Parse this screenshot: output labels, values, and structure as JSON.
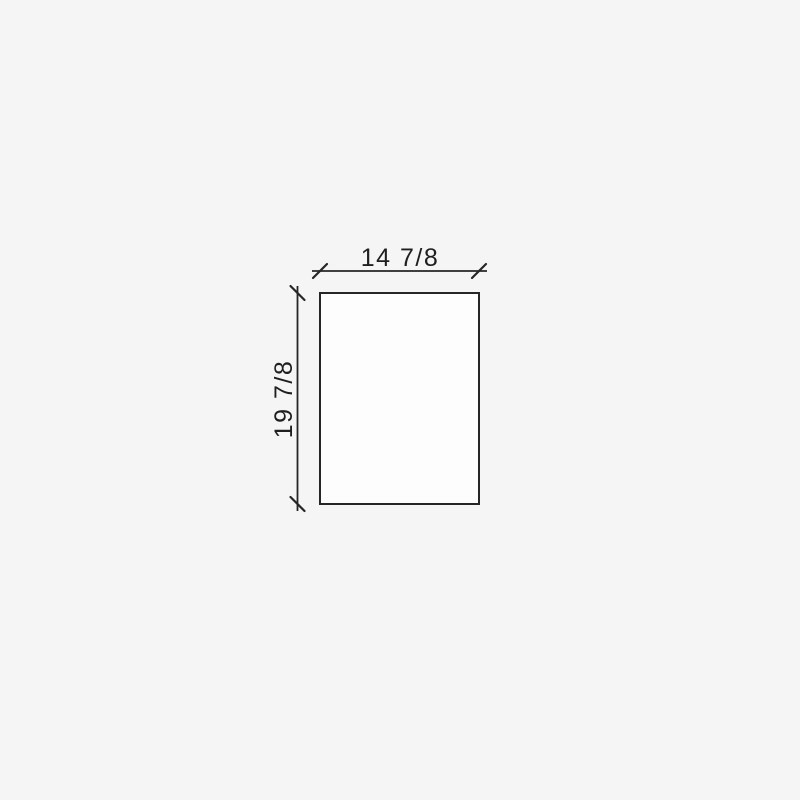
{
  "drawing": {
    "shape": "rectangle",
    "dimensions": {
      "width_label": "14 7/8",
      "height_label": "19 7/8"
    },
    "colors": {
      "background": "#f5f5f5",
      "line": "#262626",
      "shape_fill": "#fdfdfd",
      "text": "#1f1f1f"
    }
  }
}
